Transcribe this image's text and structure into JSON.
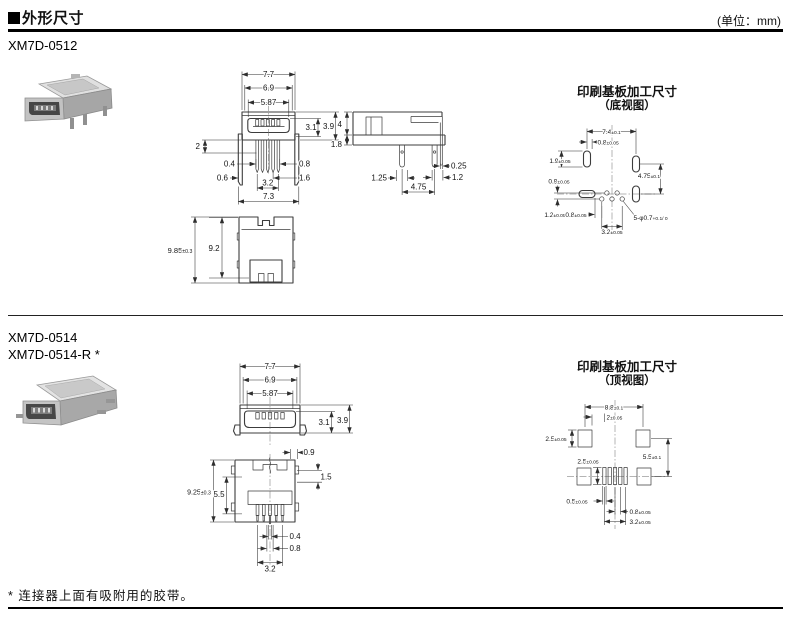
{
  "header": {
    "section_title": "外形尺寸",
    "unit_label": "(单位：mm)"
  },
  "colors": {
    "ink": "#111111",
    "drawing_line": "#3c3c3c"
  },
  "s1": {
    "model": "XM7D-0512",
    "front": {
      "w_outer": "7.7",
      "w_mid": "6.9",
      "w_inner": "5.87",
      "h_opening": "3.1",
      "h_body": "3.9",
      "pin_len": "2",
      "p04": "0.4",
      "p06": "0.6",
      "p08": "0.8",
      "p16": "1.6",
      "pin_span": "3.2",
      "w_bottom": "7.3"
    },
    "side": {
      "h4": "4",
      "h18": "1.8",
      "t025": "0.25",
      "w12": "1.2",
      "w125": "1.25",
      "pitch475": "4.75"
    },
    "top": {
      "h985": {
        "v": "9.85",
        "t": "±0.3"
      },
      "h92": "9.2"
    },
    "pcb": {
      "title": "印刷基板加工尺寸",
      "subtitle": "（底视图）",
      "d74": {
        "v": "7.4",
        "t": "±0.1"
      },
      "d08a": {
        "v": "0.8",
        "t": "±0.05"
      },
      "d19": {
        "v": "1.9",
        "t": "±0.05"
      },
      "d09": {
        "v": "0.9",
        "t": "±0.05"
      },
      "d475": {
        "v": "4.75",
        "t": "±0.1"
      },
      "d12": {
        "v": "1.2",
        "t": "±0.05"
      },
      "d08b": {
        "v": "0.8",
        "t": "±0.05"
      },
      "d32": {
        "v": "3.2",
        "t": "±0.05"
      },
      "holes": {
        "v": "5-φ0.7",
        "t": "+0.1/ 0"
      }
    }
  },
  "s2": {
    "model_a": "XM7D-0514",
    "model_b": "XM7D-0514-R *",
    "front": {
      "w_outer": "7.7",
      "w_mid": "6.9",
      "w_inner": "5.87",
      "h_opening": "3.1",
      "h_body": "3.9"
    },
    "bottom": {
      "d09": "0.9",
      "d15": "1.5",
      "h925": {
        "v": "9.25",
        "t": "±0.3"
      },
      "d55": "5.5",
      "d04": "0.4",
      "d08": "0.8",
      "d32": "3.2"
    },
    "pcb": {
      "title": "印刷基板加工尺寸",
      "subtitle": "（顶视图）",
      "d88": {
        "v": "8.8",
        "t": "±0.1"
      },
      "d2": {
        "v": "2",
        "t": "±0.05"
      },
      "d25a": {
        "v": "2.5",
        "t": "±0.05"
      },
      "d25b": {
        "v": "2.5",
        "t": "±0.05"
      },
      "d55": {
        "v": "5.5",
        "t": "±0.1"
      },
      "d05": {
        "v": "0.5",
        "t": "±0.05"
      },
      "d08": {
        "v": "0.8",
        "t": "±0.05"
      },
      "d32": {
        "v": "3.2",
        "t": "±0.05"
      }
    }
  },
  "footnote": "* 连接器上面有吸附用的胶带。"
}
